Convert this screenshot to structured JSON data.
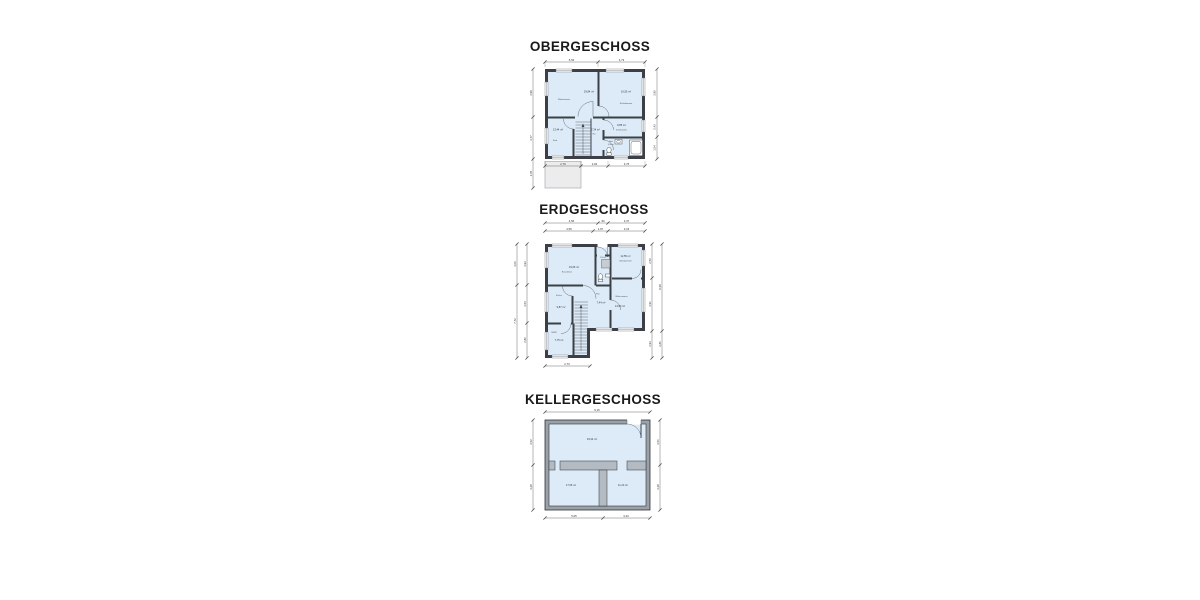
{
  "colors": {
    "room_fill": "#dcebf7",
    "wall": "#3c4046",
    "wall_fill_kg": "#9aa1a8",
    "partition_fill": "#b4bac1",
    "terrace_fill": "#ececec",
    "dim": "#4a4a4a",
    "text": "#1a1a1a"
  },
  "floors": {
    "og": {
      "title": "OBERGESCHOSS",
      "rooms": {
        "wohnzimmer": {
          "name": "Wohnzimmer",
          "area": "29,84 m²"
        },
        "schlafzimmer1": {
          "name": "Schlafzimmer",
          "area": "16,55 m²"
        },
        "kind": {
          "name": "Kind",
          "area": "13,44 m²"
        },
        "flur": {
          "name": "Flur",
          "area": "7,34 m²"
        },
        "schlafzimmer2": {
          "name": "Schlafzimmer",
          "area": "9,85 m²"
        },
        "bad": {
          "name": "Bad",
          "area": "4,06 m²"
        }
      },
      "dims": {
        "top": [
          "5,53",
          "3,73"
        ],
        "bottom": [
          "2,79",
          "2,62",
          "3,76"
        ],
        "left": [
          "3,98",
          "3,77",
          "2,65"
        ],
        "right": [
          "3,90",
          "2,43",
          "1,54"
        ]
      }
    },
    "eg": {
      "title": "ERDGESCHOSS",
      "rooms": {
        "esszimmer": {
          "name": "Esszimmer",
          "area": "19,05 m²"
        },
        "schlafzimmer": {
          "name": "Schlafzimmer",
          "area": "12,55 m²"
        },
        "wc": {
          "name": "WC",
          "area": "2,63 m²"
        },
        "kueche": {
          "name": "Küche",
          "area": "9,87 m²"
        },
        "flur": {
          "name": "Flur",
          "area": "7,44 m²"
        },
        "wohnzimmer": {
          "name": "Wohnzimmer",
          "area": "14,50 m²"
        },
        "hwr": {
          "name": "HWR",
          "area": "7,75 m²"
        }
      },
      "dims": {
        "top_row1": [
          "4,56",
          "90",
          "3,37"
        ],
        "top_row2": [
          "4,56",
          "1,97",
          "3,15"
        ],
        "left_outer": [
          "3,06",
          "7,72"
        ],
        "left_inner": [
          "3,93",
          "3,53",
          "2,86"
        ],
        "right_inner": [
          "2,50",
          "3,91",
          "2,93"
        ],
        "right_outer": [
          "8,49",
          "2,86"
        ],
        "bottom": [
          "2,73"
        ]
      }
    },
    "kg": {
      "title": "KELLERGESCHOSS",
      "rooms": {
        "keller1": {
          "area": "33,24 m²"
        },
        "keller2": {
          "area": "17,06 m²"
        },
        "keller3": {
          "area": "11,23 m²"
        }
      },
      "dims": {
        "top": [
          "9,15"
        ],
        "left": [
          "3,52",
          "3,28"
        ],
        "right": [
          "3,51",
          "3,28"
        ],
        "bottom": [
          "5,05",
          "3,43"
        ]
      }
    }
  }
}
